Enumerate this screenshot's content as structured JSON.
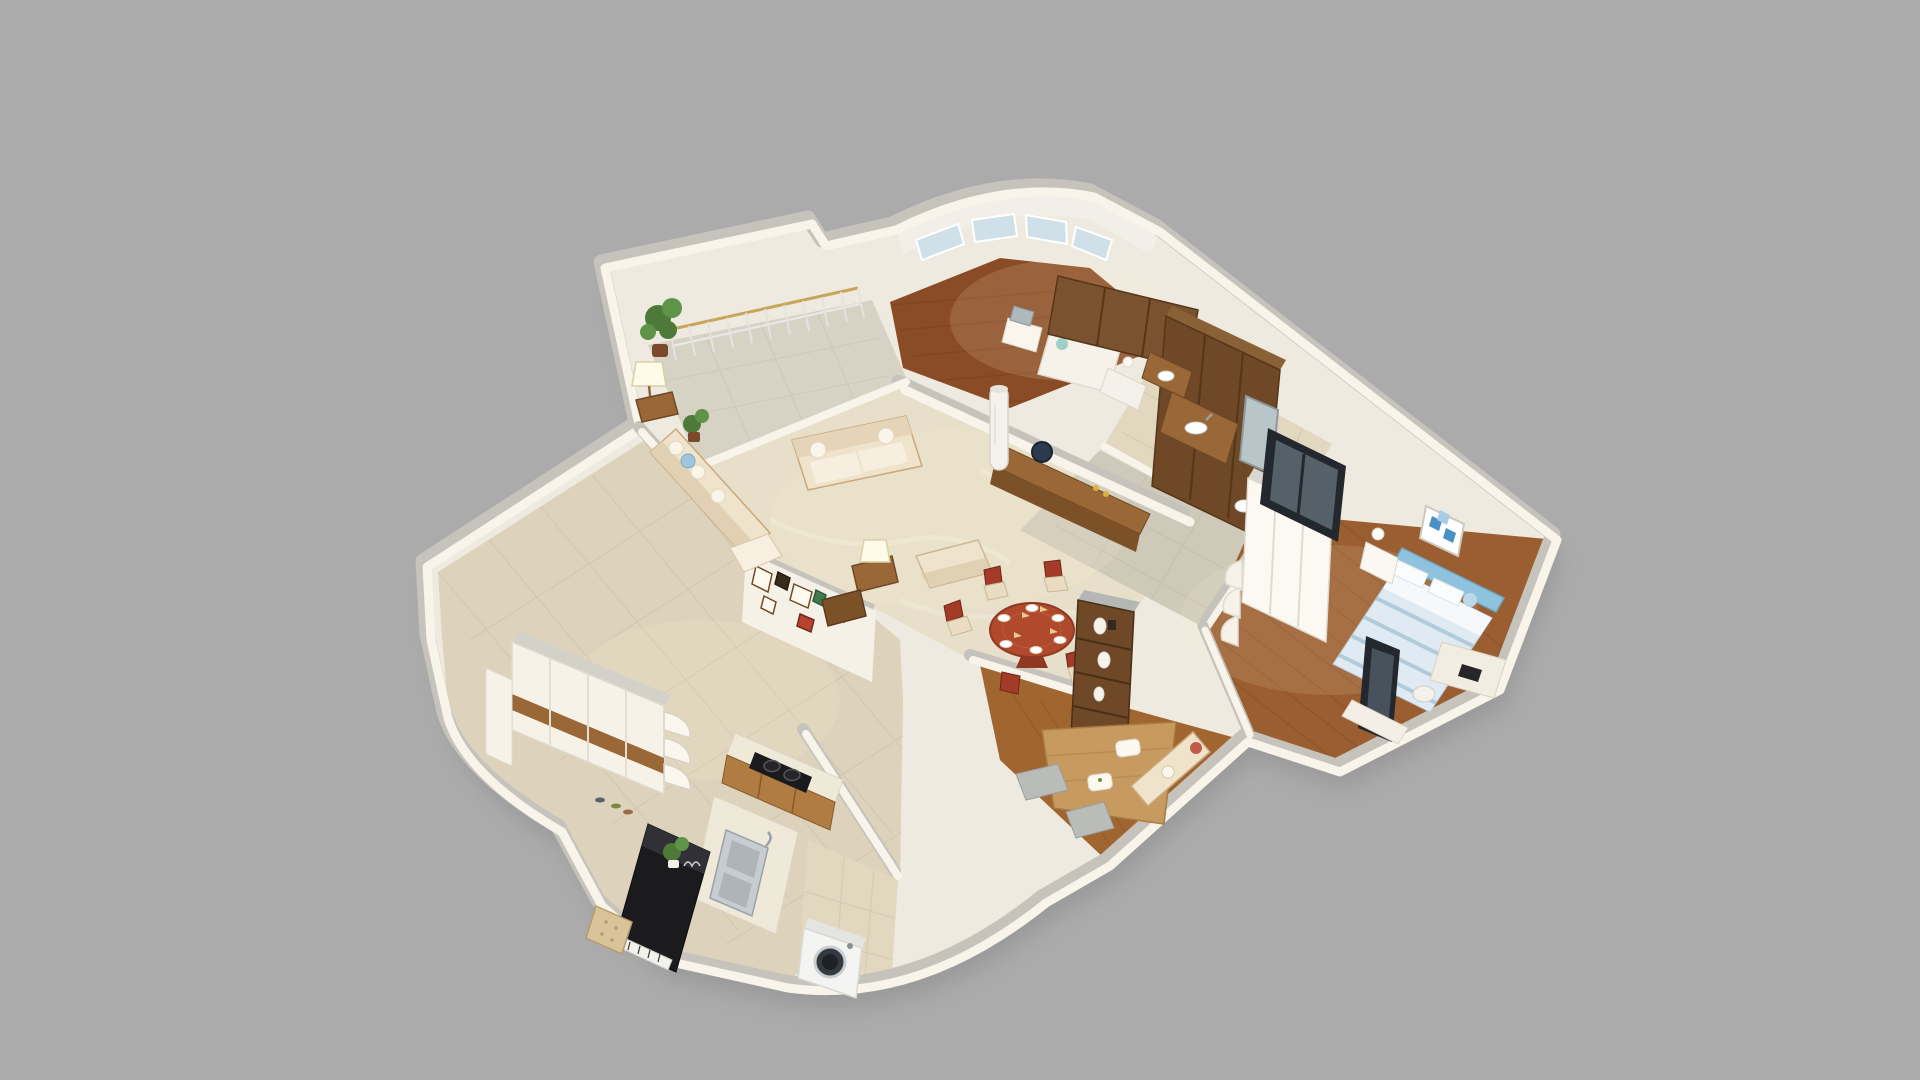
{
  "scene": {
    "type": "3d-dollhouse-floorplan-render",
    "description": "Cutaway top-down 3D render of a furnished apartment, rotated in perspective, on a plain gray background. No text or UI controls are visible.",
    "background": "#ababab",
    "view": "elevated three-quarter view, walls cut at mid height"
  },
  "palette": {
    "background": "#ababab",
    "shadow": "#828282",
    "wall_base": "#efeae0",
    "wall_face": "#f8f4ea",
    "wall_top": "#c6c3bd",
    "floor_marble": "#e7dfc9",
    "balcony_tile": "#d6d2c4",
    "kitchen_tile": "#ddd3bc",
    "hall_tile": "#cfc9b9",
    "bath_tile": "#e2d8c0",
    "wood_floor_dark": "#8a4c26",
    "wood_floor_master": "#9a5e30",
    "wood_floor_tatami": "#a1652f",
    "wood_platform": "#c79a5f",
    "wood_dark": "#6e4827",
    "wood_mid": "#9a6736",
    "table_red": "#b14a2c",
    "sofa_beige": "#f0e3cc",
    "cushion_white": "#faf5e9",
    "bed_blue": "#8fc3dd",
    "bedding_blue": "#dfeaf2",
    "black": "#1b1b1e",
    "steel": "#c7ccd1",
    "glass": "#cfe0e8",
    "plant_green": "#4d7a39",
    "gold": "#c9a55a"
  },
  "rooms": [
    {
      "id": "balcony",
      "label": "Balcony",
      "floor": "light gray tile",
      "items": [
        "arched metal railing with gold top rail",
        "tall potted plant",
        "small potted plant",
        "floor lamp"
      ]
    },
    {
      "id": "living-room",
      "label": "Living Room",
      "floor": "cream marble tile",
      "items": [
        "two-seat fabric sofa",
        "long wall sofa with chaise and pillows",
        "side tables with lamps",
        "ottoman",
        "wood TV cabinet with round dark fan decor",
        "white column air conditioner"
      ]
    },
    {
      "id": "dining-area",
      "label": "Dining Area",
      "floor": "cream marble tile",
      "items": [
        "round red-wood pedestal table with place settings",
        "red-back dining chairs",
        "tall wood display cabinet with white vases"
      ]
    },
    {
      "id": "bedroom-2",
      "label": "Bedroom 2",
      "floor": "dark red-brown wood",
      "items": [
        "curved bay window",
        "low white bed with teal cushion",
        "two large brown wardrobes",
        "white vanity with mirror"
      ]
    },
    {
      "id": "bathroom",
      "label": "Bathroom",
      "floor": "beige tile",
      "items": [
        "wood vanity with white basin",
        "tall framed mirror",
        "glass shower enclosure",
        "toilet",
        "bathtub edge",
        "second wood vanity"
      ]
    },
    {
      "id": "hallway",
      "label": "Hallway",
      "floor": "gray tile",
      "items": []
    },
    {
      "id": "master-bedroom",
      "label": "Master Bedroom",
      "floor": "wood planks",
      "items": [
        "double bed with blue tufted headboard and blue-white striped bedding",
        "white nightstand with ball lamp",
        "blue checkered wall art",
        "white wardrobe with curved corner shelves",
        "desk with dark laptop",
        "white desk chair",
        "dark standing mirror",
        "tall dark window frame",
        "white foot bench"
      ]
    },
    {
      "id": "tatami-room",
      "label": "Tatami Lounge",
      "floor": "wood planks",
      "items": [
        "raised light-wood platform",
        "white and floral floor cushions",
        "gray low tables",
        "small beige sofa with red pillow"
      ]
    },
    {
      "id": "kitchen",
      "label": "Kitchen",
      "floor": "large beige tile",
      "items": [
        "wood-front counter",
        "black two-burner gas cooktop",
        "stainless steel double sink with faucet"
      ]
    },
    {
      "id": "entry",
      "label": "Entry / Foyer",
      "floor": "large beige tile",
      "items": [
        "white storage cabinet with horizontal wood stripe",
        "curved white corner shelves",
        "shoes on floor"
      ]
    },
    {
      "id": "piano-corner",
      "label": "Piano Corner",
      "items": [
        "black upright piano with sheet music",
        "green plant on piano",
        "tufted beige bench"
      ]
    },
    {
      "id": "laundry",
      "label": "Laundry Nook",
      "floor": "beige tile",
      "items": [
        "white front-load washing machine with dark round door"
      ]
    }
  ]
}
